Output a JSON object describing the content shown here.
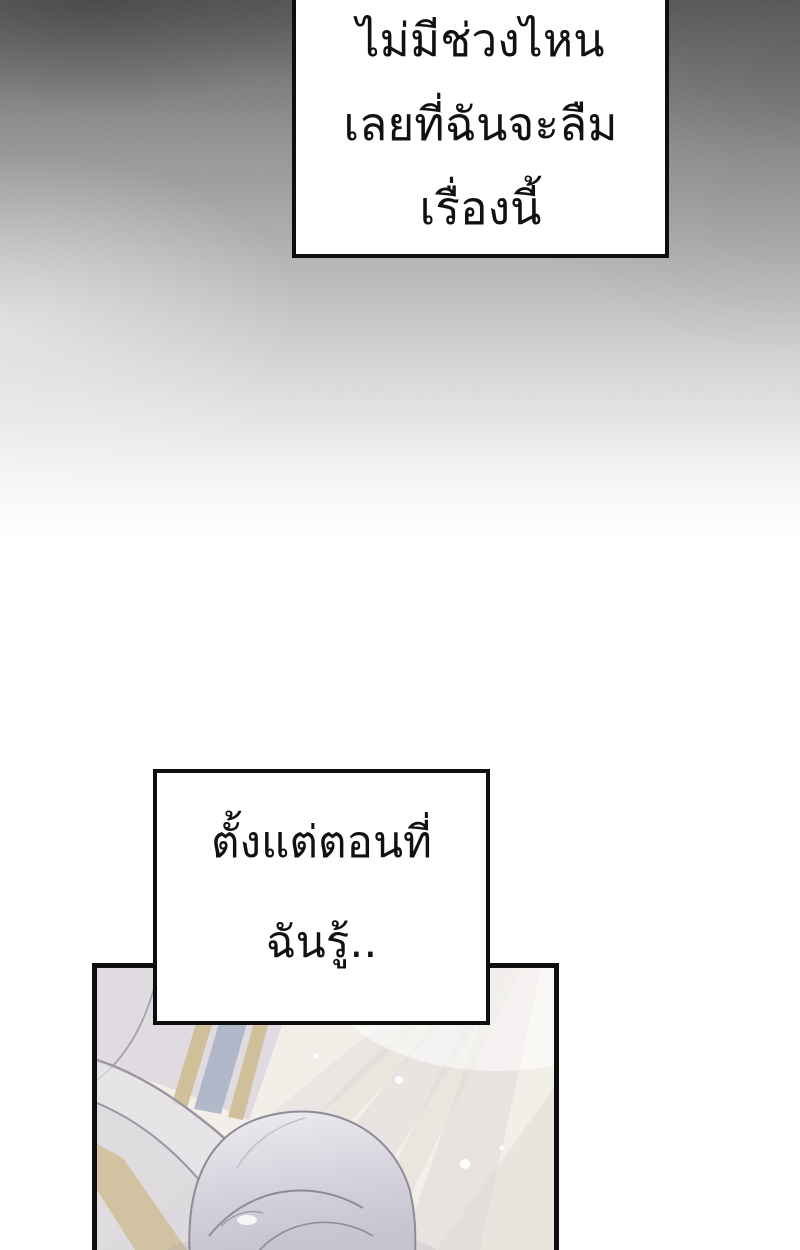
{
  "page": {
    "kind": "comic-page",
    "width": 800,
    "height": 1250,
    "background": "#ffffff"
  },
  "colors": {
    "ink": "#0e0e0e",
    "text": "#111111",
    "sky_top": "#525252",
    "art_base": "#f2efe9",
    "art_lavender": "#d9d6dd",
    "art_lavender_light": "#e3e0e6",
    "art_tan": "#cdbc92",
    "art_blue": "#a7b0c3",
    "art_head_light": "#ecebee",
    "art_head_dark": "#cbc8d4",
    "art_outline": "#938f9b",
    "art_beam": "#cfc8d2",
    "art_beam_warm": "#d8d0c2"
  },
  "narration_boxes": [
    {
      "name": "top",
      "lines": [
        "ไม่มีช่วงไหน",
        "เลยที่ฉันจะลืม",
        "เรื่องนี้"
      ]
    },
    {
      "name": "middle",
      "lines": [
        "ตั้งแต่ตอนที่",
        "ฉันรู้.."
      ]
    }
  ]
}
